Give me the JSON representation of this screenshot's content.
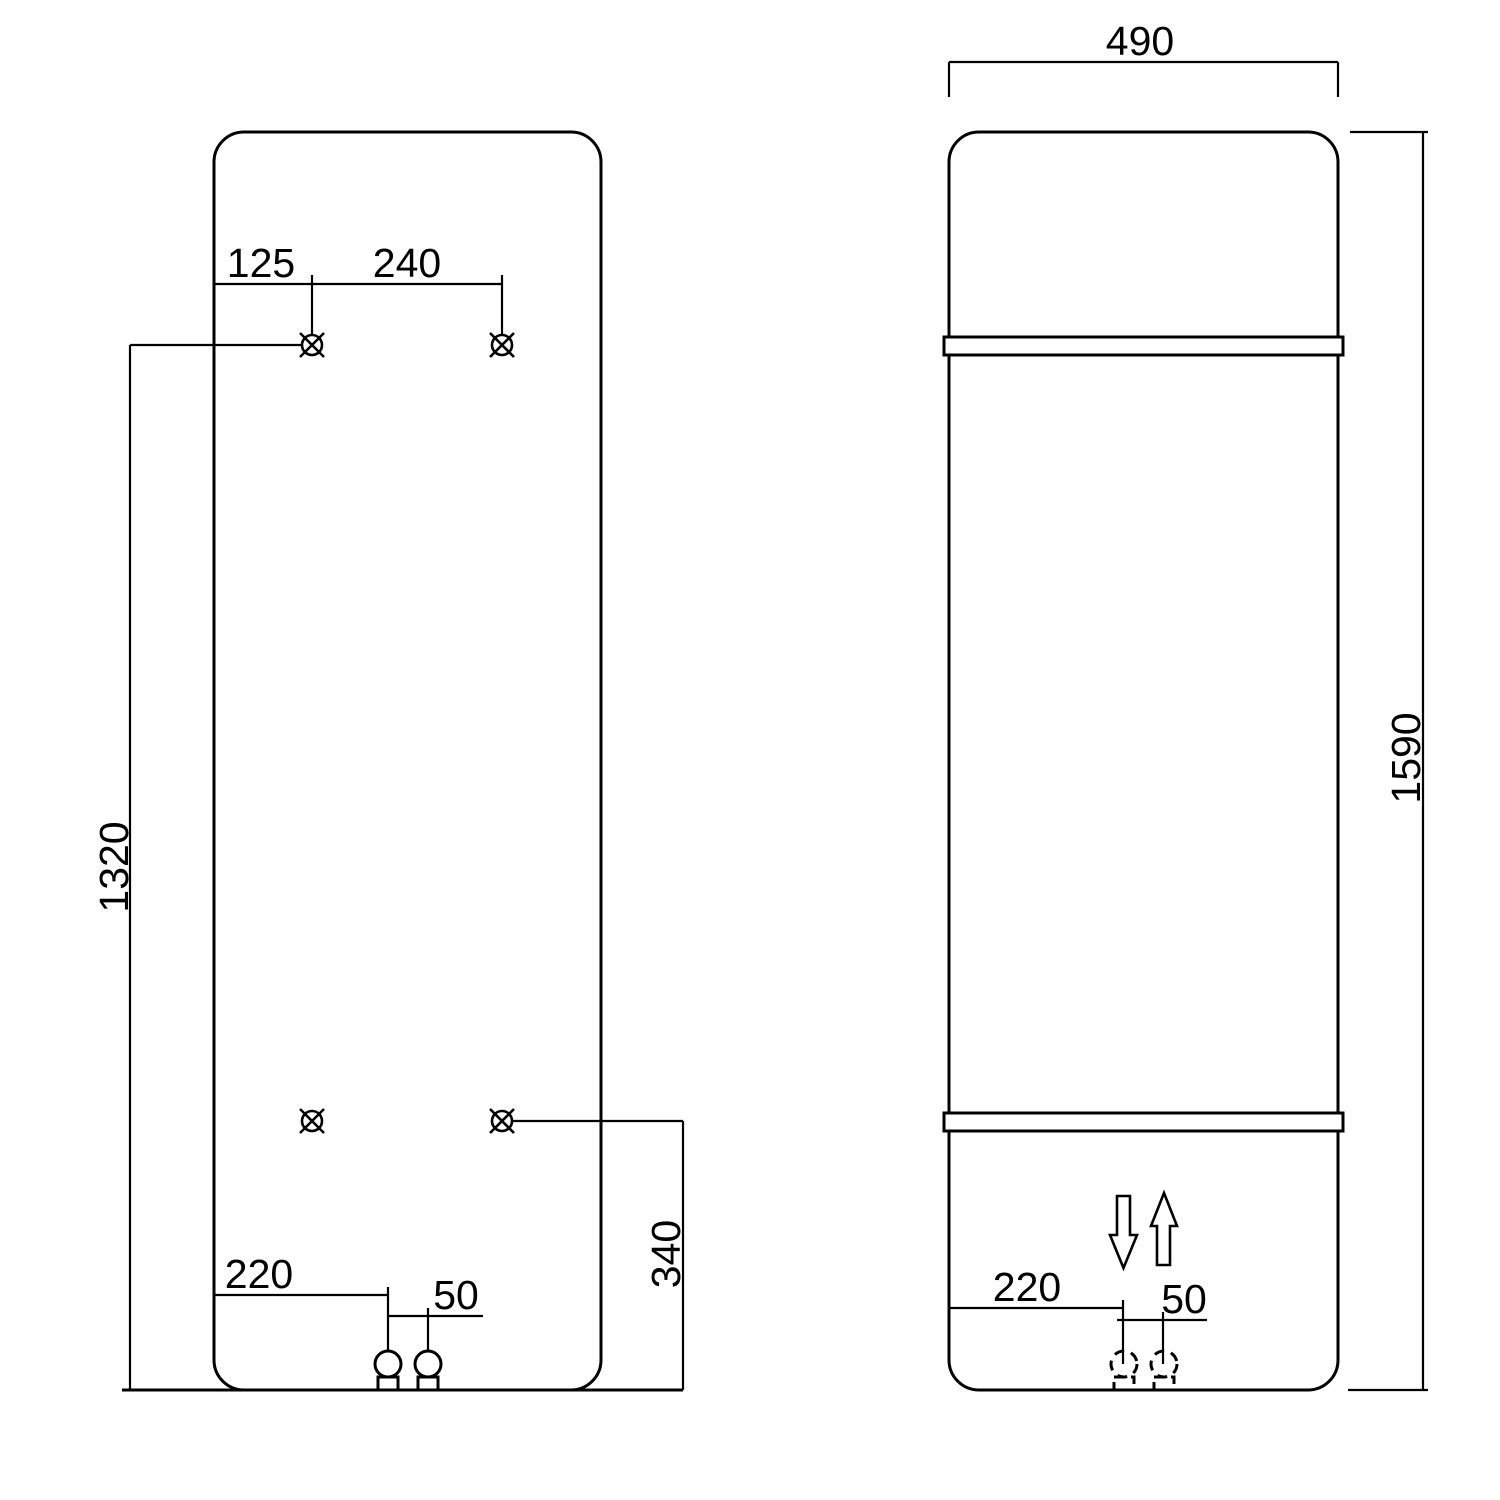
{
  "colors": {
    "line": "#000000",
    "background": "#ffffff"
  },
  "rear_view": {
    "top_hole_offset": "125",
    "top_hole_spacing": "240",
    "mount_height": "1320",
    "pipe_offset": "220",
    "pipe_spacing": "50",
    "lower_mount_height": "340"
  },
  "front_view": {
    "overall_width": "490",
    "overall_height": "1590",
    "pipe_offset": "220",
    "pipe_spacing": "50"
  },
  "icons": {
    "mounting_point": "circle-cross",
    "pipe_connection": "circle-with-stub",
    "pipe_connection_hidden": "dashed-circle-with-stub",
    "flow_out": "down-arrow-outline",
    "flow_in": "up-arrow-outline"
  }
}
